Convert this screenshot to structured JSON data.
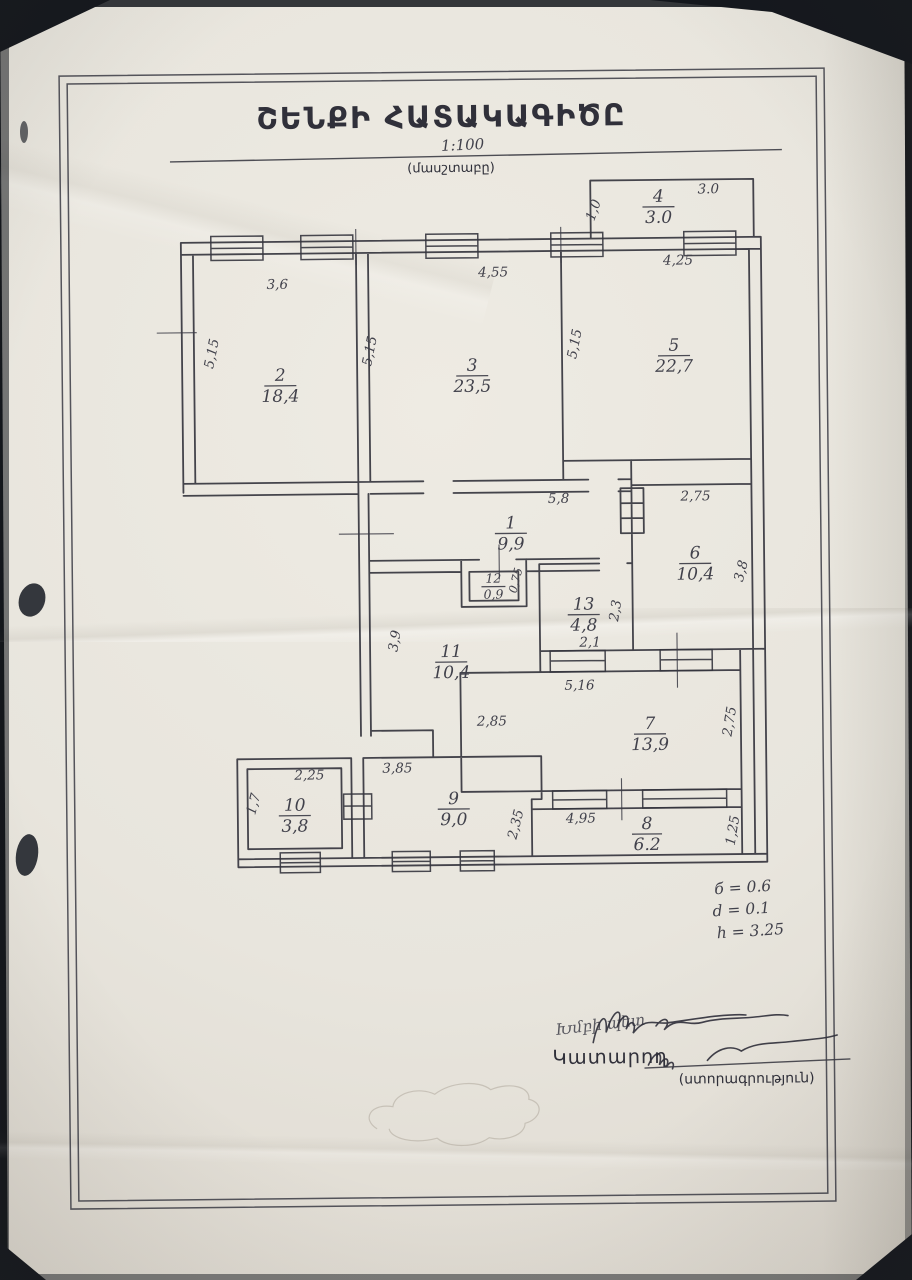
{
  "page": {
    "title": "ՇԵՆՔԻ ՀԱՏԱԿԱԳԻԾԸ",
    "scale": "1:100",
    "scale_caption": "(մասշտաբը)"
  },
  "plan": {
    "rooms": [
      {
        "number": "1",
        "area": "9,9"
      },
      {
        "number": "2",
        "area": "18,4"
      },
      {
        "number": "3",
        "area": "23,5"
      },
      {
        "number": "4",
        "area": "3.0"
      },
      {
        "number": "5",
        "area": "22,7"
      },
      {
        "number": "6",
        "area": "10,4"
      },
      {
        "number": "7",
        "area": "13,9"
      },
      {
        "number": "8",
        "area": "6.2"
      },
      {
        "number": "9",
        "area": "9,0"
      },
      {
        "number": "10",
        "area": "3,8"
      },
      {
        "number": "11",
        "area": "10,4"
      },
      {
        "number": "12",
        "area": "0,9"
      },
      {
        "number": "13",
        "area": "4,8"
      }
    ],
    "dims": {
      "r1_w": "5,8",
      "r2_w": "3,6",
      "r2_h": "5,15",
      "r3_w": "4,55",
      "r3_h": "5,15",
      "r4_w": "3.0",
      "r4_h": "1,0",
      "r5_w": "4,25",
      "r5_h": "5,15",
      "r6_w": "2,75",
      "r6_h": "3,8",
      "r7_w": "5,16",
      "r7_h": "2,75",
      "r8_w": "4,95",
      "r8_h": "1,25",
      "r9_w": "3,85",
      "r9_h": "2,35",
      "r10_w": "2,25",
      "r10_h": "1,7",
      "r11_h": "3,9",
      "r11_w": "2,85",
      "r12_h": "0,75",
      "r13_w": "2,1",
      "r13_h": "2,3"
    }
  },
  "notes": {
    "line1": "б = 0.6",
    "line2": "d = 0.1",
    "line3": "h = 3.25"
  },
  "footer": {
    "handwritten_role": "Խմբի պետ",
    "executor_label": "Կատարող",
    "signature_caption": "(ստորագրություն)"
  }
}
